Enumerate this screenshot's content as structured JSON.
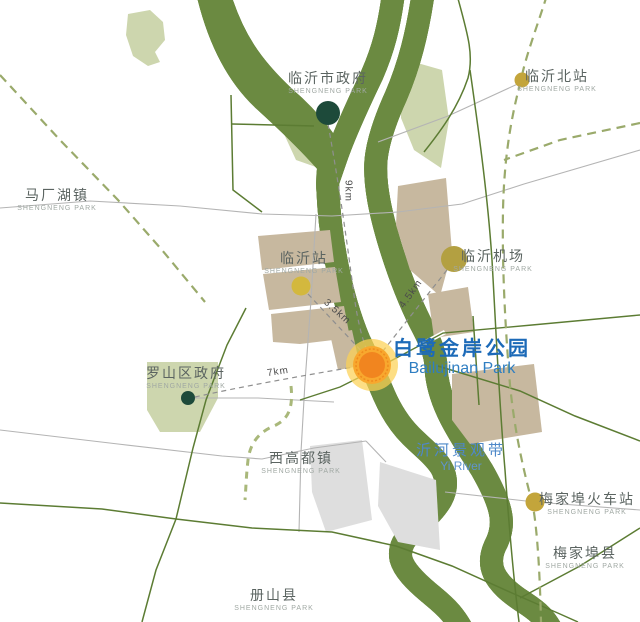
{
  "park": {
    "zh": "白鹭金岸公园",
    "en": "Bailujinan Park"
  },
  "river": {
    "zh": "沂河景观带",
    "en": "Yi River"
  },
  "labels": {
    "city_gov": {
      "zh": "临沂市政府",
      "sub": "SHENGNENG PARK"
    },
    "north_station": {
      "zh": "临沂北站",
      "sub": "SHENGNENG PARK"
    },
    "machanghu": {
      "zh": "马厂湖镇",
      "sub": "SHENGNENG PARK"
    },
    "linyi_station": {
      "zh": "临沂站",
      "sub": "SHENGNENG PARK"
    },
    "airport": {
      "zh": "临沂机场",
      "sub": "SHENGNENG PARK"
    },
    "luoshan_gov": {
      "zh": "罗山区政府",
      "sub": "SHENGNENG PARK"
    },
    "xigaodu": {
      "zh": "西高都镇",
      "sub": "SHENGNENG PARK"
    },
    "meijiabu_station": {
      "zh": "梅家埠火车站",
      "sub": "SHENGNENG PARK"
    },
    "meijiabu_county": {
      "zh": "梅家埠县",
      "sub": "SHENGNENG PARK"
    },
    "ceshan": {
      "zh": "册山县",
      "sub": "SHENGNENG PARK"
    }
  },
  "distances": {
    "to_city_gov": "9km",
    "to_linyi_station": "3.5km",
    "to_airport": "4.5km",
    "to_luoshan_gov": "7km"
  },
  "colors": {
    "river_blue": "#7BA9BD",
    "bank_green": "#CBD5AB",
    "road_olive": "#5C7C33",
    "rail_dash_olive": "#9AAA6B",
    "block_tan": "#C7B89F",
    "block_gray": "#DEDEDE",
    "dot_dark_green": "#1D4A3A",
    "dot_yellow": "#C3A53B",
    "park_marker_orange": "#F1851F",
    "label_blue": "#1C6AB8"
  }
}
